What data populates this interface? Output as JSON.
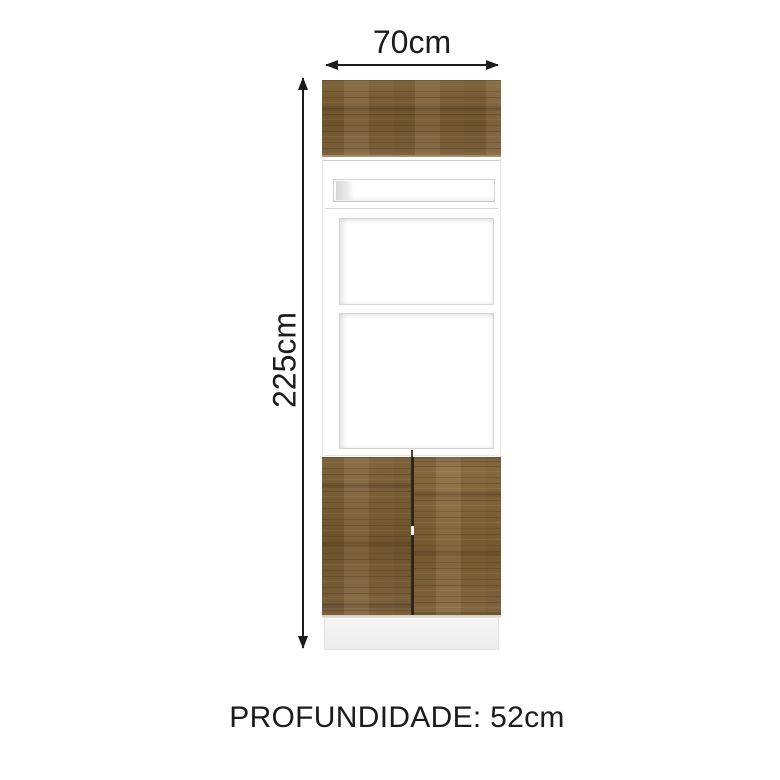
{
  "diagram": {
    "width_label": "70cm",
    "height_label": "225cm",
    "depth_label": "PROFUNDIDADE: 52cm"
  },
  "colors": {
    "wood_base": "#7d6239",
    "wood_dark": "#5e4827",
    "wood_light": "#97794b",
    "carcass_white": "#ffffff",
    "edge_gray": "#d4d4d4",
    "plinth_gray": "#f2f2f2",
    "door_gap_dark": "#2e2619",
    "annotation_black": "#1b1b1b"
  }
}
